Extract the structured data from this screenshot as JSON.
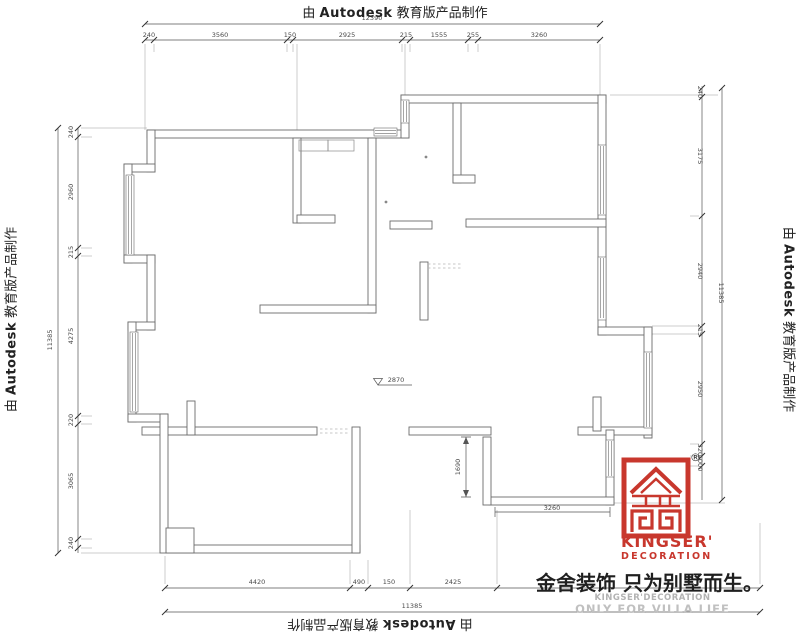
{
  "edge_label": {
    "prefix": "由 ",
    "brand": "Autodesk",
    "suffix": " 教育版产品制作"
  },
  "dimensions": {
    "top": {
      "total": "12390",
      "segments": [
        "240",
        "3560",
        "150",
        "2925",
        "215",
        "1555",
        "255",
        "3260"
      ]
    },
    "left": {
      "total": "11385",
      "segments": [
        "240",
        "2960",
        "215",
        "4275",
        "220",
        "3065",
        "240"
      ]
    },
    "right": {
      "total": "11385",
      "segments": [
        "240",
        "3175",
        "2940",
        "215",
        "2950",
        "320",
        "1000"
      ]
    },
    "bottom": {
      "total": "11385",
      "segments": [
        "4420",
        "490",
        "150",
        "2425"
      ]
    },
    "interior": {
      "level": "2870",
      "room_height": "1690",
      "room_width": "3260"
    }
  },
  "logo": {
    "registered": "®",
    "name": "KINGSER'",
    "name2": "DECORATION",
    "tagline_cn": "金舍装饰 只为别墅而生。",
    "sub_en1": "KINGSER'DECORATION",
    "sub_en2": "ONLY FOR VILLA LIFE",
    "accent_color": "#C8372D"
  }
}
